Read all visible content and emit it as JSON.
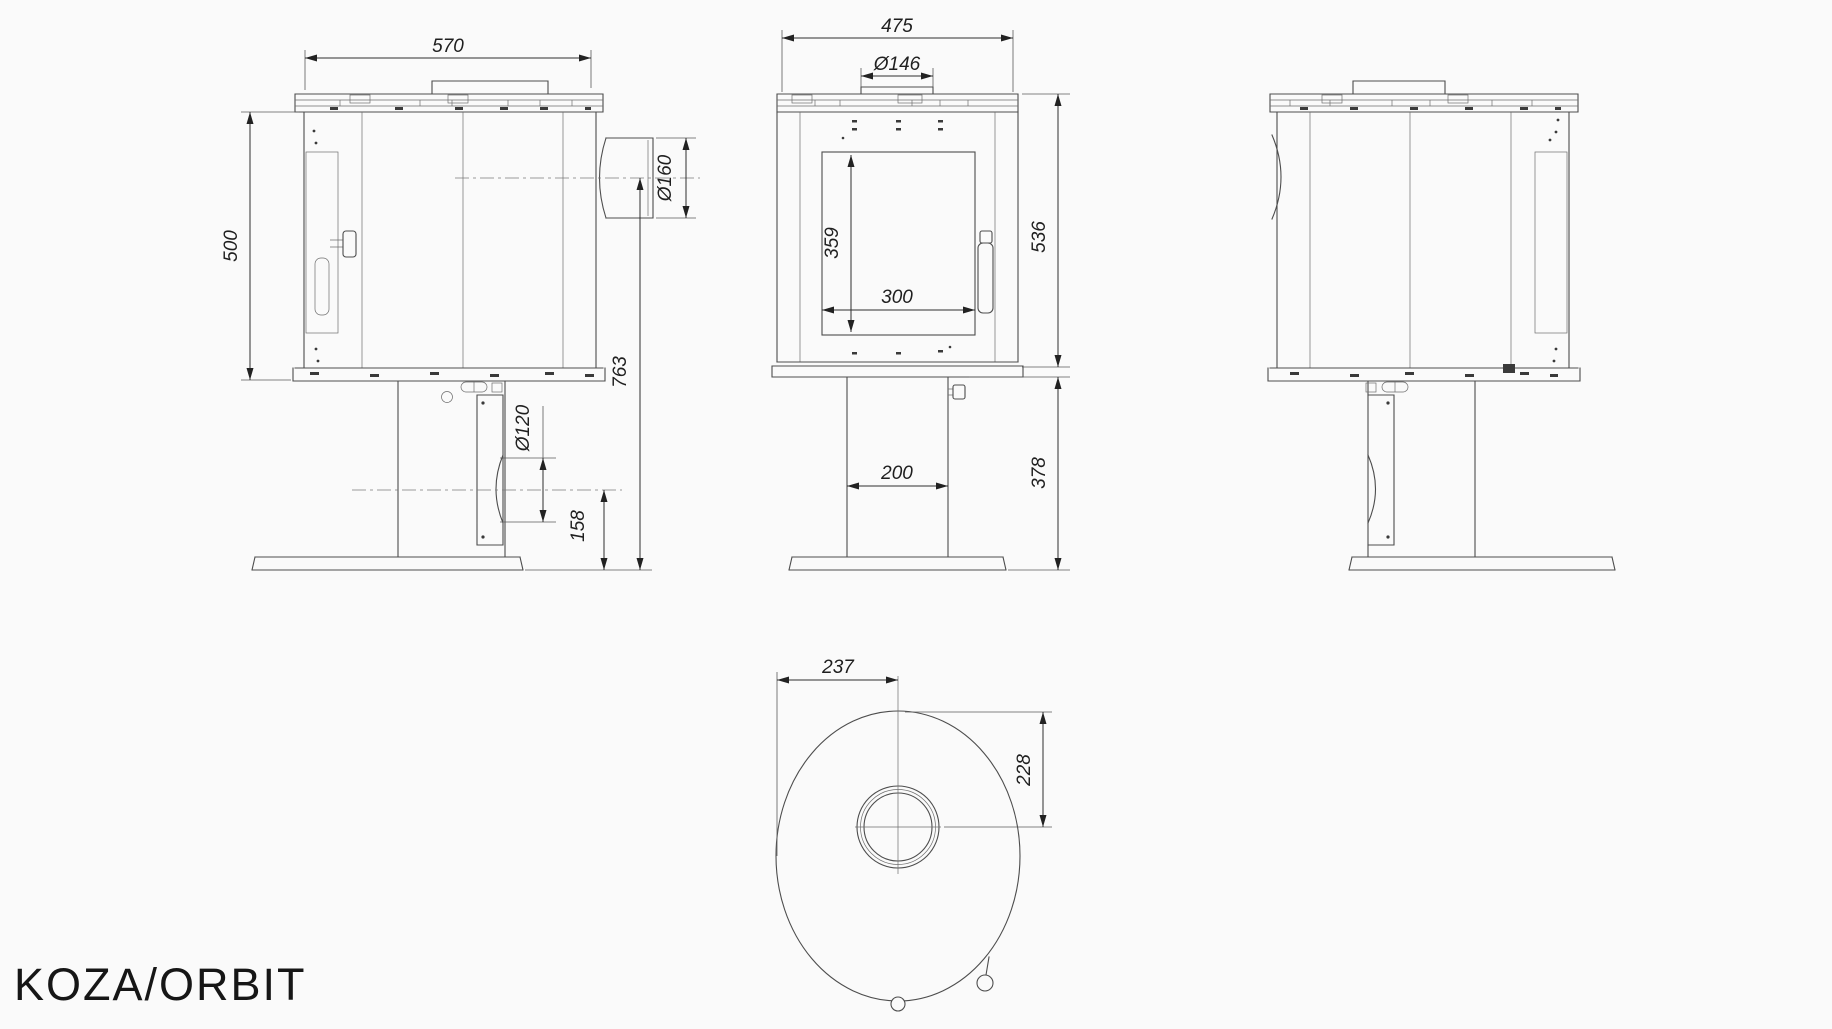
{
  "title": "KOZA/ORBIT",
  "colors": {
    "line": "#4d4d4d",
    "text": "#1f1f1f",
    "background": "#fafafa"
  },
  "views": {
    "left_side": {
      "label": "left side view",
      "dims": {
        "width": "570",
        "height": "500",
        "flue_diameter": "Ø160",
        "flue_axis_height": "763",
        "rear_hole_diameter": "Ø120",
        "rear_hole_axis_height": "158"
      }
    },
    "front": {
      "label": "front view",
      "dims": {
        "width": "475",
        "collar_diameter": "Ø146",
        "glass_height": "359",
        "glass_width": "300",
        "body_height": "536",
        "pedestal_width": "200",
        "pedestal_height": "378"
      }
    },
    "right_side": {
      "label": "right side view"
    },
    "top": {
      "label": "top view",
      "dims": {
        "left_to_flue_axis": "237",
        "front_to_flue_axis": "228"
      }
    }
  }
}
